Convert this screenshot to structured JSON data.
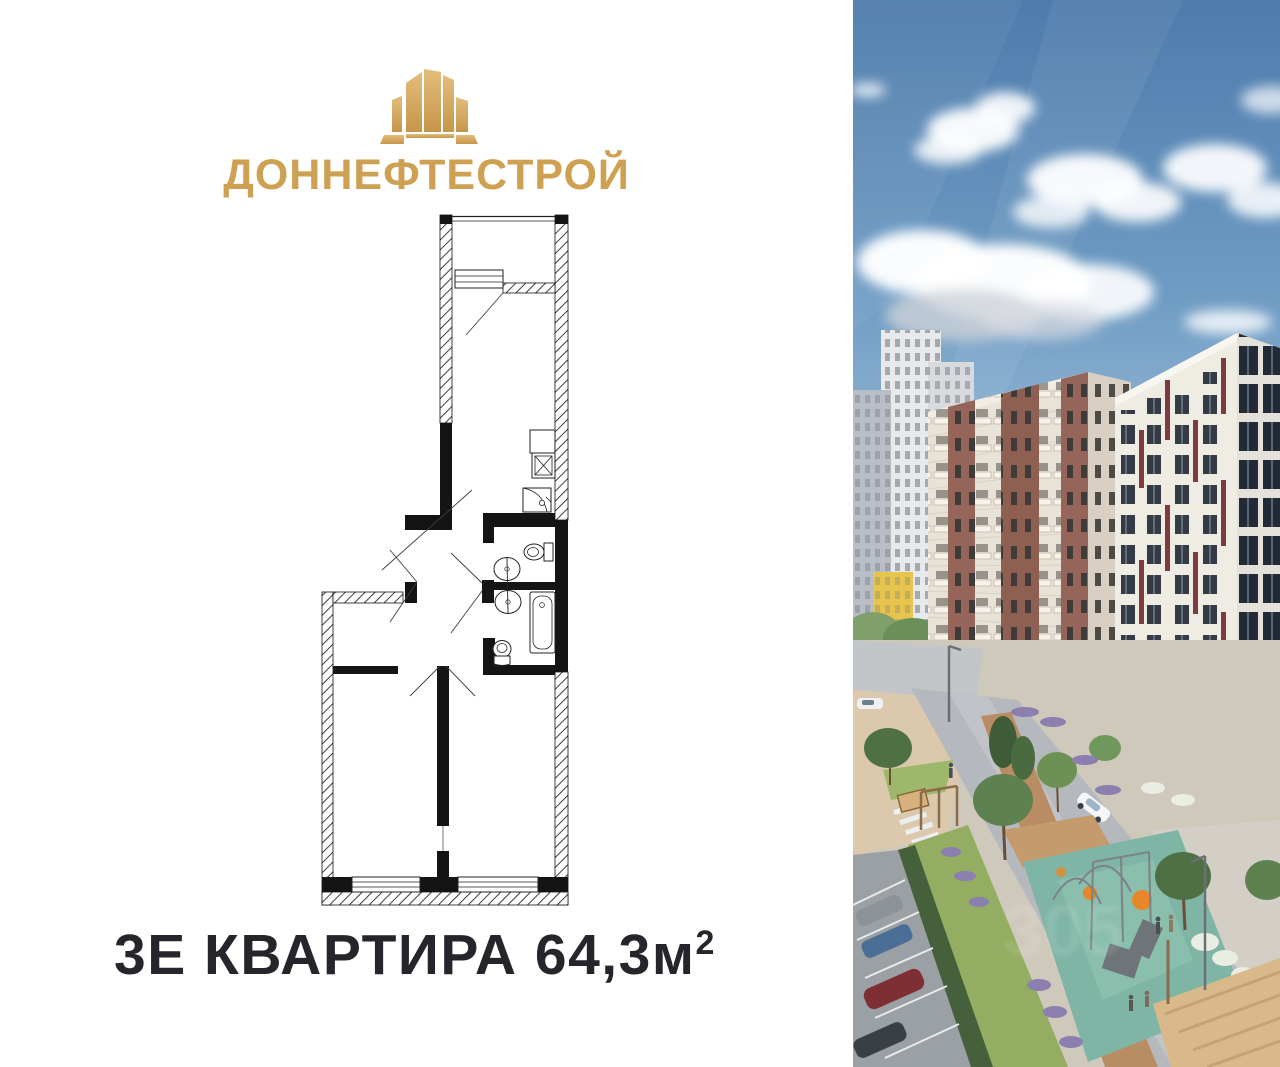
{
  "brand": {
    "name": "ДОННЕФТЕСТРОЙ"
  },
  "plan": {
    "caption_title": "3Е КВАРТИРА",
    "caption_area": "64,3м",
    "caption_area_sup": "2"
  },
  "photo": {
    "watermark": "305"
  },
  "colors": {
    "gold": "#cda052",
    "caption_text": "#24262c",
    "plan_wall": "#141414",
    "sky_top": "#4d7bac",
    "sky_bottom": "#d4e2ee",
    "facade_cream": "#e9e2d6",
    "facade_brick": "#96655a",
    "facade_maroon": "#7d3a40",
    "window_dark": "#2c3340",
    "playground_teal": "#7fb5a5",
    "accent_orange": "#e8872a",
    "lawn_green": "#93ad62"
  }
}
